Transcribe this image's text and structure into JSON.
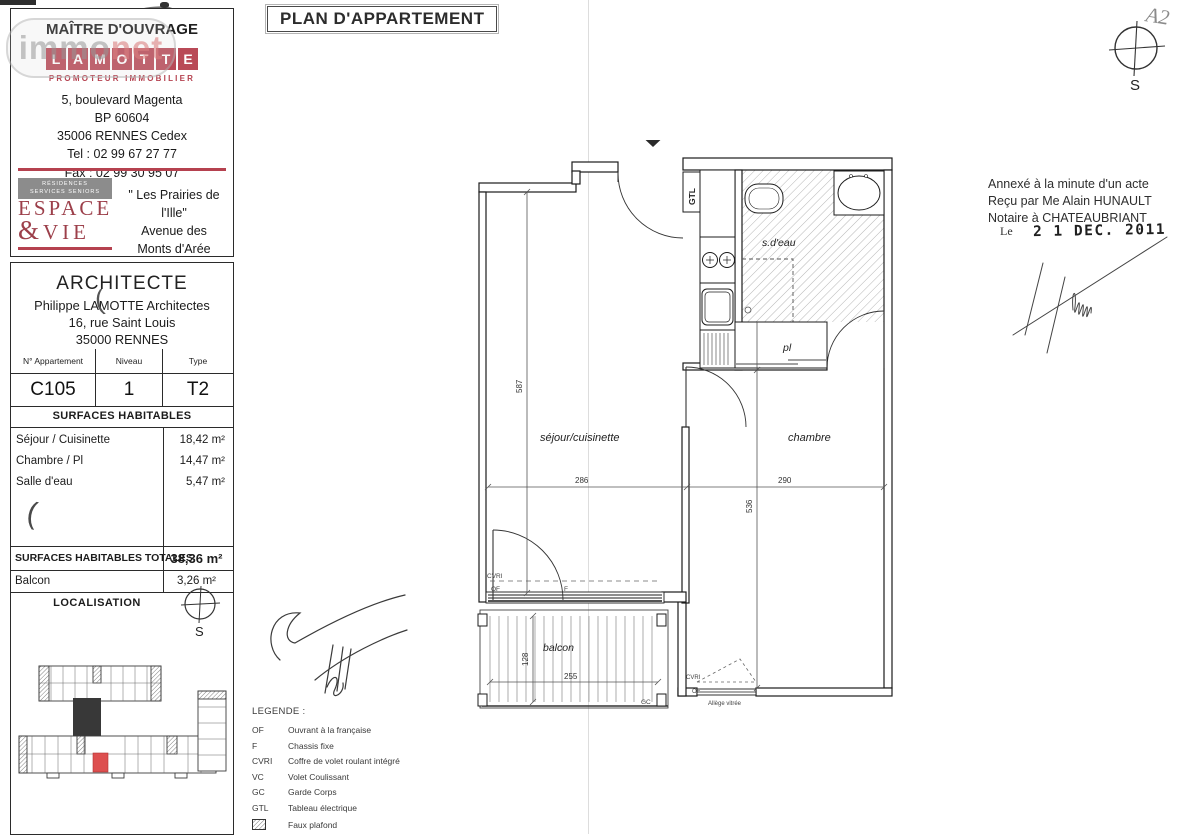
{
  "watermark": {
    "immo": "immo",
    "net": "net"
  },
  "artifacts": {
    "curve": "(",
    "crescent": "("
  },
  "header": {
    "title": "PLAN D'APPARTEMENT",
    "sheet_note": "A2"
  },
  "maitre": {
    "heading": "MAÎTRE D'OUVRAGE",
    "logo_letters": [
      "L",
      "A",
      "M",
      "O",
      "T",
      "T",
      "E"
    ],
    "logo_subtitle": "PROMOTEUR IMMOBILIER",
    "address": [
      "5, boulevard Magenta",
      "BP 60604",
      "35006 RENNES Cedex",
      "Tel : 02 99 67 27 77",
      "Fax : 02 99 30 95 07"
    ],
    "espace_vie": {
      "tag1": "RÉSIDENCES",
      "tag2": "SERVICES SENIORS",
      "name1": "ESPACE",
      "amp": "&",
      "name2": "VIE"
    },
    "project": [
      "\" Les Prairies de l'Ille\"",
      "Avenue des",
      "Monts d'Arée",
      "RENNES"
    ]
  },
  "architecte": {
    "heading": "ARCHITECTE",
    "lines": [
      "Philippe LAMOTTE Architectes",
      "16, rue Saint Louis",
      "35000 RENNES"
    ]
  },
  "apartment": {
    "headers": [
      "N° Appartement",
      "Niveau",
      "Type"
    ],
    "number": "C105",
    "niveau": "1",
    "type": "T2"
  },
  "surfaces": {
    "heading": "SURFACES HABITABLES",
    "rows": [
      {
        "label": "Séjour / Cuisinette",
        "value": "18,42 m²"
      },
      {
        "label": "Chambre / Pl",
        "value": "14,47 m²"
      },
      {
        "label": "Salle d'eau",
        "value": "5,47 m²"
      }
    ],
    "total_label": "SURFACES HABITABLES TOTALES",
    "total_value": "38,36 m²",
    "balcon_label": "Balcon",
    "balcon_value": "3,26 m²"
  },
  "localisation": {
    "heading": "LOCALISATION",
    "south": "S"
  },
  "plan": {
    "unit": "C105",
    "rooms": {
      "sejour": "séjour/cuisinette",
      "chambre": "chambre",
      "sdeau": "s.d'eau",
      "pl": "pl",
      "balcon": "balcon",
      "gtl": "GTL"
    },
    "dims": {
      "h587": "587",
      "w286": "286",
      "w290": "290",
      "h536": "536",
      "h128": "128",
      "w255": "255"
    },
    "labels": {
      "cvri": "CVRI",
      "of": "OF",
      "f": "F",
      "gc": "GC",
      "cvri2": "CVRI",
      "of2": "OF",
      "allege": "Allège vitrée"
    }
  },
  "legend": {
    "heading": "LEGENDE :",
    "entries": [
      {
        "abbr": "OF",
        "label": "Ouvrant à la française"
      },
      {
        "abbr": "F",
        "label": "Chassis fixe"
      },
      {
        "abbr": "CVRI",
        "label": "Coffre de volet roulant intégré"
      },
      {
        "abbr": "VC",
        "label": "Volet Coulissant"
      },
      {
        "abbr": "GC",
        "label": "Garde Corps"
      },
      {
        "abbr": "GTL",
        "label": "Tableau électrique"
      },
      {
        "abbr": "",
        "label": "Faux plafond"
      }
    ]
  },
  "notary": {
    "lines": [
      "Annexé à la minute d'un acte",
      "Reçu par Me Alain HUNAULT",
      "Notaire à CHATEAUBRIANT"
    ],
    "le": "Le",
    "date": "2 1 DEC. 2011"
  },
  "compass": {
    "south": "S"
  },
  "colors": {
    "brand_red": "#b5414f",
    "highlight_red": "#dd4f4f"
  }
}
